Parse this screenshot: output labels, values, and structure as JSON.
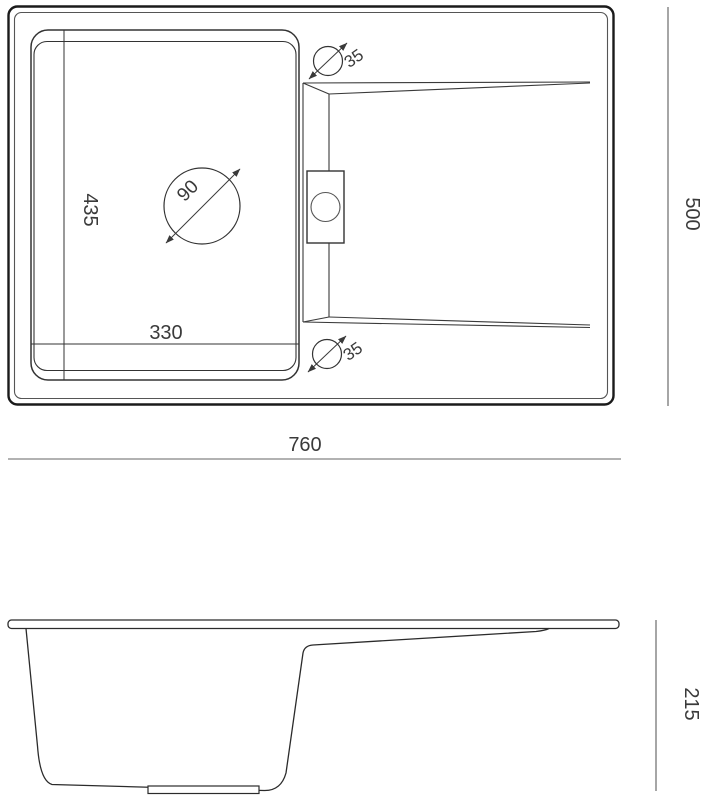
{
  "page": {
    "background": "#ffffff",
    "line_color": "#333333",
    "heavy_line_color": "#1a1a1a",
    "dim_line_color": "#8a8a8a"
  },
  "drawing": {
    "type": "sink-technical-drawing",
    "views": {
      "top_view": "plan view of sink with bowl, drainboard, drain hole and tap holes",
      "side_view": "side profile of sink with bowl depth and drainboard"
    },
    "dimensions": {
      "bowl_depth": "435",
      "bowl_width": "330",
      "drain_diameter": "90",
      "tap_hole_top_diameter": "35",
      "tap_hole_bottom_diameter": "35",
      "overall_width": "760",
      "overall_depth": "500",
      "overall_height": "215"
    }
  }
}
